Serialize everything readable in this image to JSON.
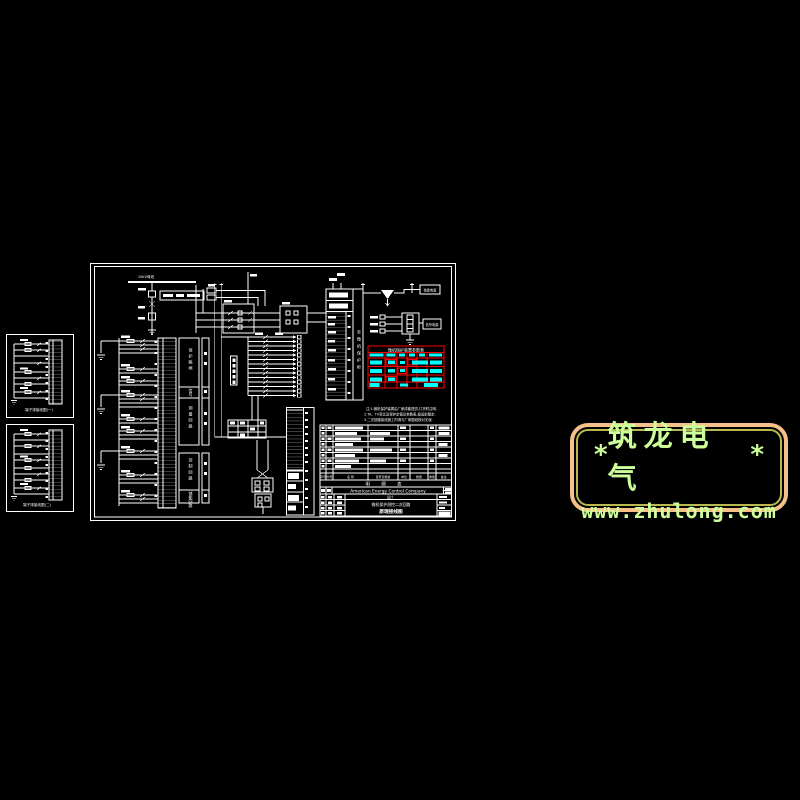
{
  "logo": {
    "asterisk_left": "*",
    "brand": "筑龙电气",
    "asterisk_right": "*",
    "url": "www.zhulong.com",
    "border_color": "#F5C189",
    "inner_line_color": "#B8BA50",
    "text_color": "#CCFF99"
  },
  "drawing": {
    "busbar_label": "10kV母线",
    "scheme_box_label": "微机保护测控屏",
    "device_column_label": "保护装置",
    "pt_box_label": "装置电源",
    "aux_box_label": "信号电源",
    "right_strip_side_label": "至微机保护柜",
    "left_sections": [
      "保护跳闸",
      "信号",
      "测量回路",
      "控制回路",
      "储能回路"
    ],
    "red_table_title": "微机保护装置参数表",
    "notes": [
      "注:1.微机保护装置由厂家成套提供,订货时注明.",
      "2.TA、TV变比及保护定值见参数表,投运前整定.",
      "3.二次回路接线施工时请与厂家图纸核对无误."
    ],
    "material_table_headers": [
      "序号",
      "代号",
      "名 称",
      "型号及规格",
      "单位",
      "数量",
      "重量",
      "备注"
    ],
    "detail_table_title": "明 细 表",
    "title_block": {
      "company": "American Energy Control Company",
      "project": "设计",
      "drawing_title_line1": "微机保护测控二次回路",
      "drawing_title_line2": "原理接线图"
    },
    "left_box1_caption": "端子排接线图(一)",
    "left_box2_caption": "端子排接线图(二)",
    "colors": {
      "line": "#FFFFFF",
      "alert": "#FF0000",
      "param": "#00FFFF",
      "background": "#000000"
    }
  }
}
